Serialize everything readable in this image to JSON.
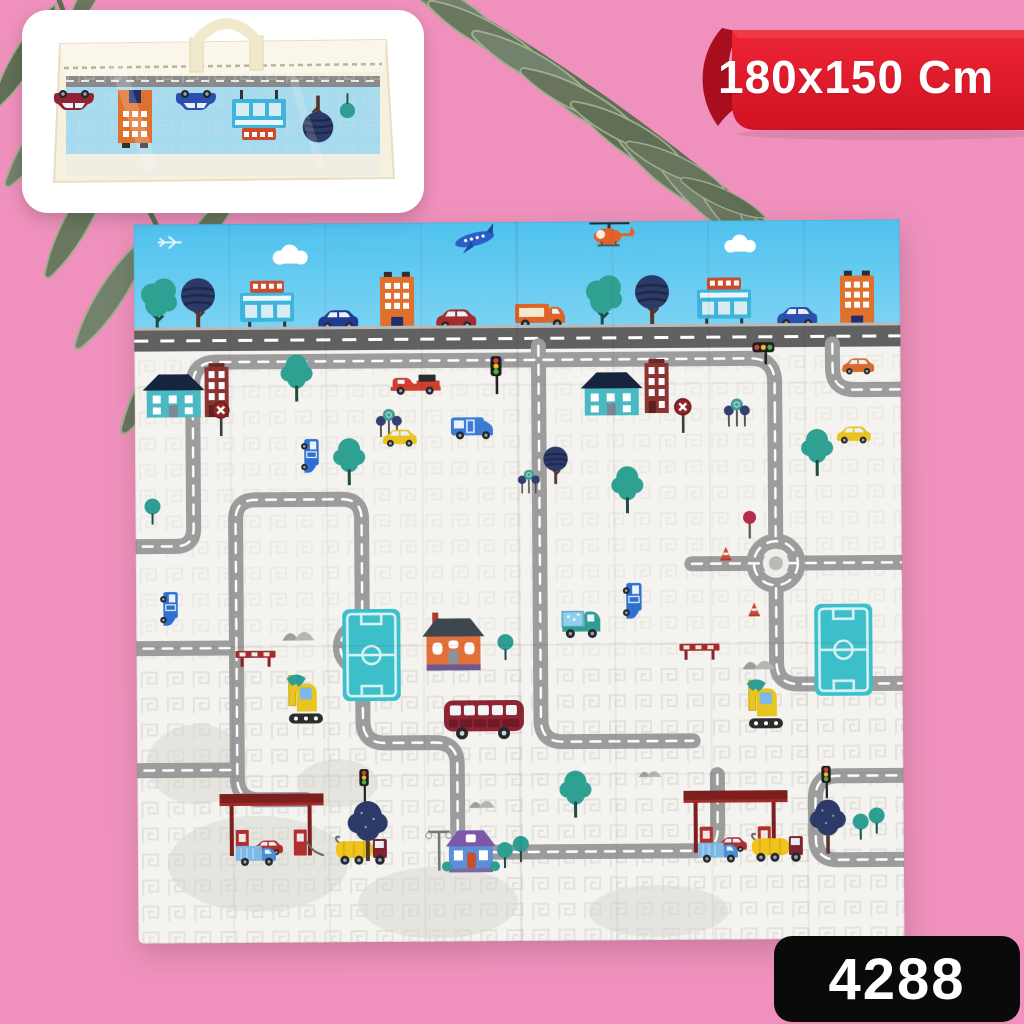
{
  "scene": {
    "type": "e-commerce product photo",
    "subject": "foldable baby play mat with town road-map print",
    "background_color": "#ef91bc"
  },
  "ribbon": {
    "label": "180x150 Cm",
    "bg_color": "#e31b2d",
    "fold_color": "#a80e1e",
    "text_color": "#ffffff"
  },
  "badge": {
    "label": "4288",
    "bg_color": "#0a0a0a",
    "text_color": "#ffffff"
  },
  "inset_photo": {
    "description": "folded play mat packed in translucent zip bag with cream handle",
    "bag_color": "#f6f1de",
    "mat_color": "#a6daee"
  },
  "play_mat": {
    "sky_color": "#55c6ee",
    "base_color": "#f4f3ef",
    "road_color": "#9c9c9c",
    "dark_road_color": "#616161",
    "elements": [
      "clouds",
      "airplane",
      "helicopter",
      "trees",
      "billboards",
      "buildings",
      "cars",
      "vans",
      "trucks",
      "bus",
      "pickup",
      "excavators",
      "gas-stations",
      "traffic-lights",
      "road-signs",
      "cones",
      "barriers",
      "houses",
      "soccer-fields",
      "roundabouts",
      "street-lamp",
      "mountains"
    ]
  },
  "palm_leaves": {
    "color": "#66785c",
    "positions": [
      "left",
      "top-center"
    ]
  }
}
